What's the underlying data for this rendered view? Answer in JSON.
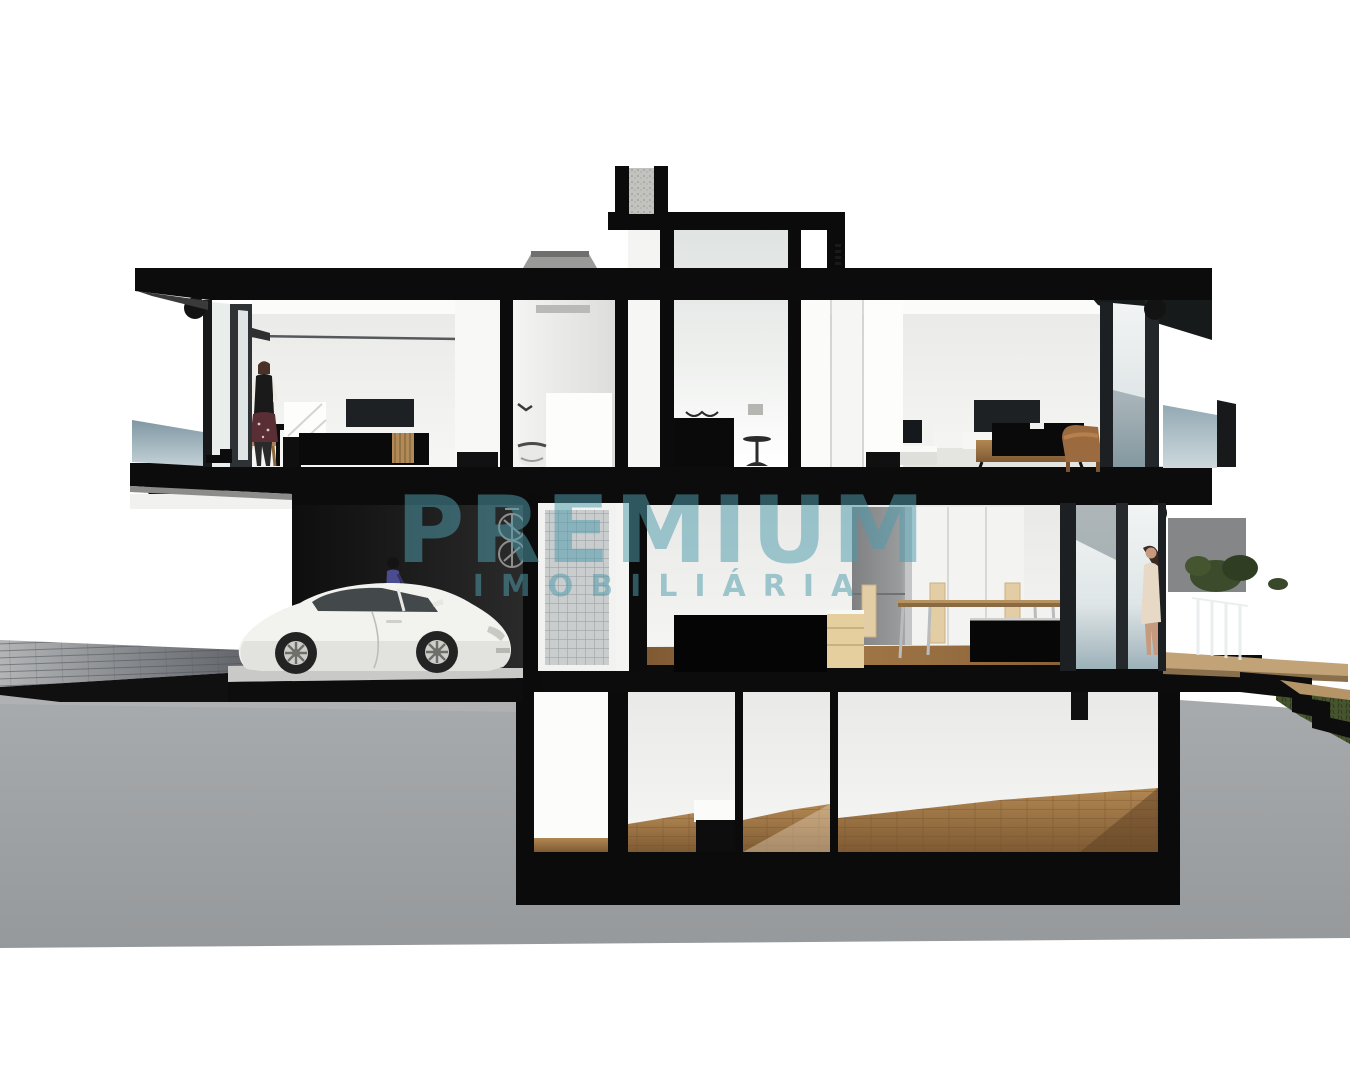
{
  "canvas": {
    "width": 1350,
    "height": 1080,
    "background": "#ffffff"
  },
  "watermark": {
    "line1": "PREMIUM",
    "line2": "IMOBILIÁRIA",
    "color": "#4f9dad",
    "opacity": "0.52"
  },
  "palette": {
    "structure_black": "#0d0d0d",
    "earth_gray": "#9fa2a4",
    "interior_wall": "#f0f0ee",
    "ceiling_white": "#fafaf8",
    "wood_floor": "#9a7244",
    "wood_furniture": "#b08a57",
    "glass_railing_blue": "#8ba2ad",
    "glass_block_gray": "#c9cdce",
    "grass_green": "#47552f",
    "car_white": "#f2f2ef",
    "driveway_gray": "#85888c",
    "concrete_panel_gray": "#8e9092"
  }
}
